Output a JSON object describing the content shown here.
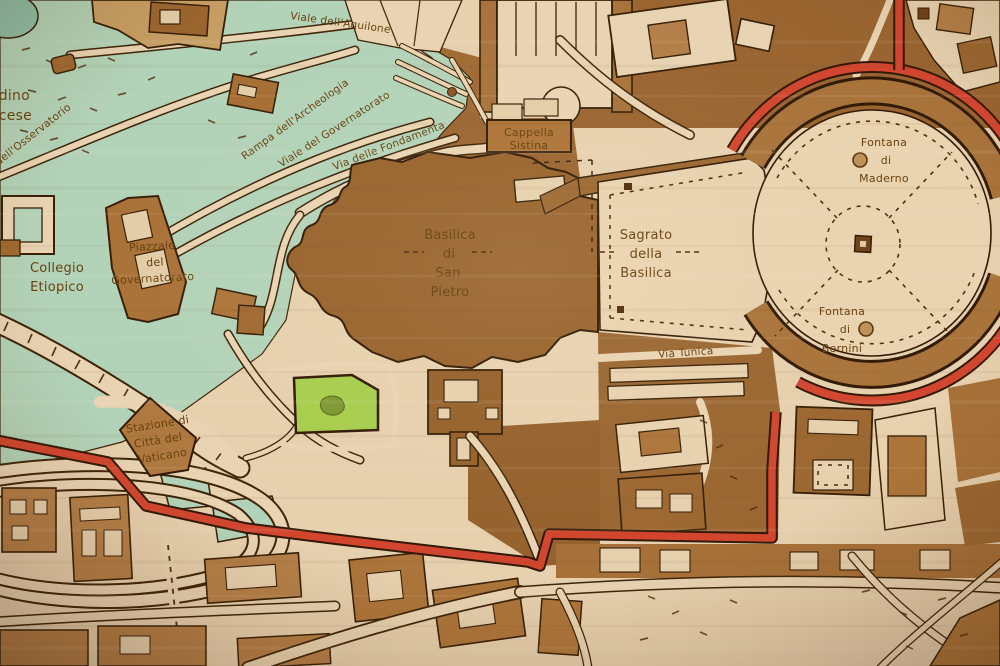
{
  "map": {
    "kind": "laser-engraved wooden city map",
    "area": "Vatican City / St. Peter's Basilica",
    "labels": {
      "viale_aquilone": "Viale dell'Aquilone",
      "osservatorio_fragment": "dell'Osservatorio",
      "giardino_fragment_1": "dino",
      "giardino_fragment_2": "cese",
      "rampa_archeologia": "Rampa dell'Archeologia",
      "viale_governatorato": "Viale del Governatorato",
      "via_fondamenta": "Via delle Fondamenta",
      "collegio_line1": "Collegio",
      "collegio_line2": "Etiopico",
      "piazzale_line1": "Piazzale",
      "piazzale_line2": "del",
      "piazzale_line3": "Governatorato",
      "stazione_line1": "Stazione di",
      "stazione_line2": "Città del",
      "stazione_line3": "Vaticano",
      "cappella_line1": "Cappella",
      "cappella_line2": "Sistina",
      "basilica_line1": "Basilica",
      "basilica_line2": "di",
      "basilica_line3": "San",
      "basilica_line4": "Pietro",
      "sagrato_line1": "Sagrato",
      "sagrato_line2": "della",
      "sagrato_line3": "Basilica",
      "maderno_line1": "Fontana",
      "maderno_line2": "di",
      "maderno_line3": "Maderno",
      "bernini_line1": "Fontana",
      "bernini_line2": "di",
      "bernini_line3": "Bernini",
      "via_tunica": "Via Tunica"
    },
    "markers": {
      "obelisk": "small square with light centre",
      "fountain": "engraved circle"
    },
    "colors": {
      "wood_light": "#ecd7b6",
      "wood_mid": "#b5804a",
      "wood_dark": "#98632d",
      "park_green": "#b4d8bf",
      "pond_green": "#8fc4ae",
      "lawn_green": "#a8d24f",
      "boundary_red": "#d5452f",
      "engraving_line": "#331d06",
      "label_brown": "#66400f"
    }
  }
}
